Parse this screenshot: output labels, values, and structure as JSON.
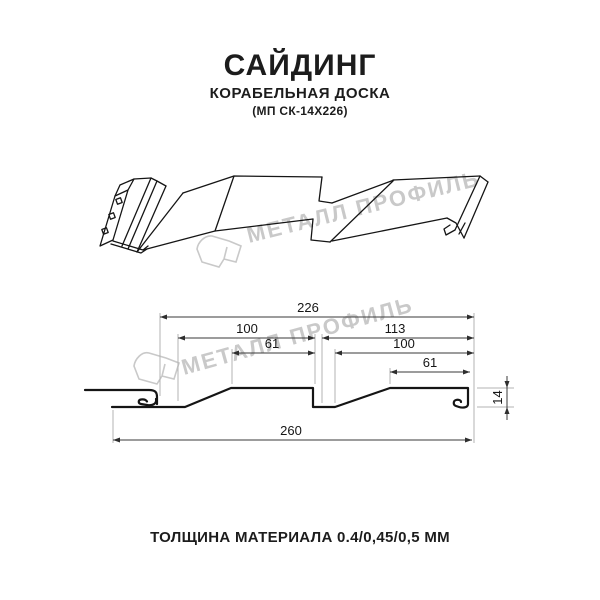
{
  "header": {
    "title": "САЙДИНГ",
    "subtitle": "КОРАБЕЛЬНАЯ ДОСКА",
    "code": "(МП СК-14Х226)"
  },
  "watermark": {
    "text": "МЕТАЛЛ ПРОФИЛЬ",
    "color": "#c9c9c9"
  },
  "dimensions": {
    "total_width": "226",
    "left_pitch": "100",
    "right_pitch": "113",
    "left_flat": "61",
    "right_inner": "100",
    "right_flat": "61",
    "overall": "260",
    "height": "14"
  },
  "footer": {
    "text": "ТОЛЩИНА МАТЕРИАЛА 0.4/0,45/0,5 ММ"
  }
}
